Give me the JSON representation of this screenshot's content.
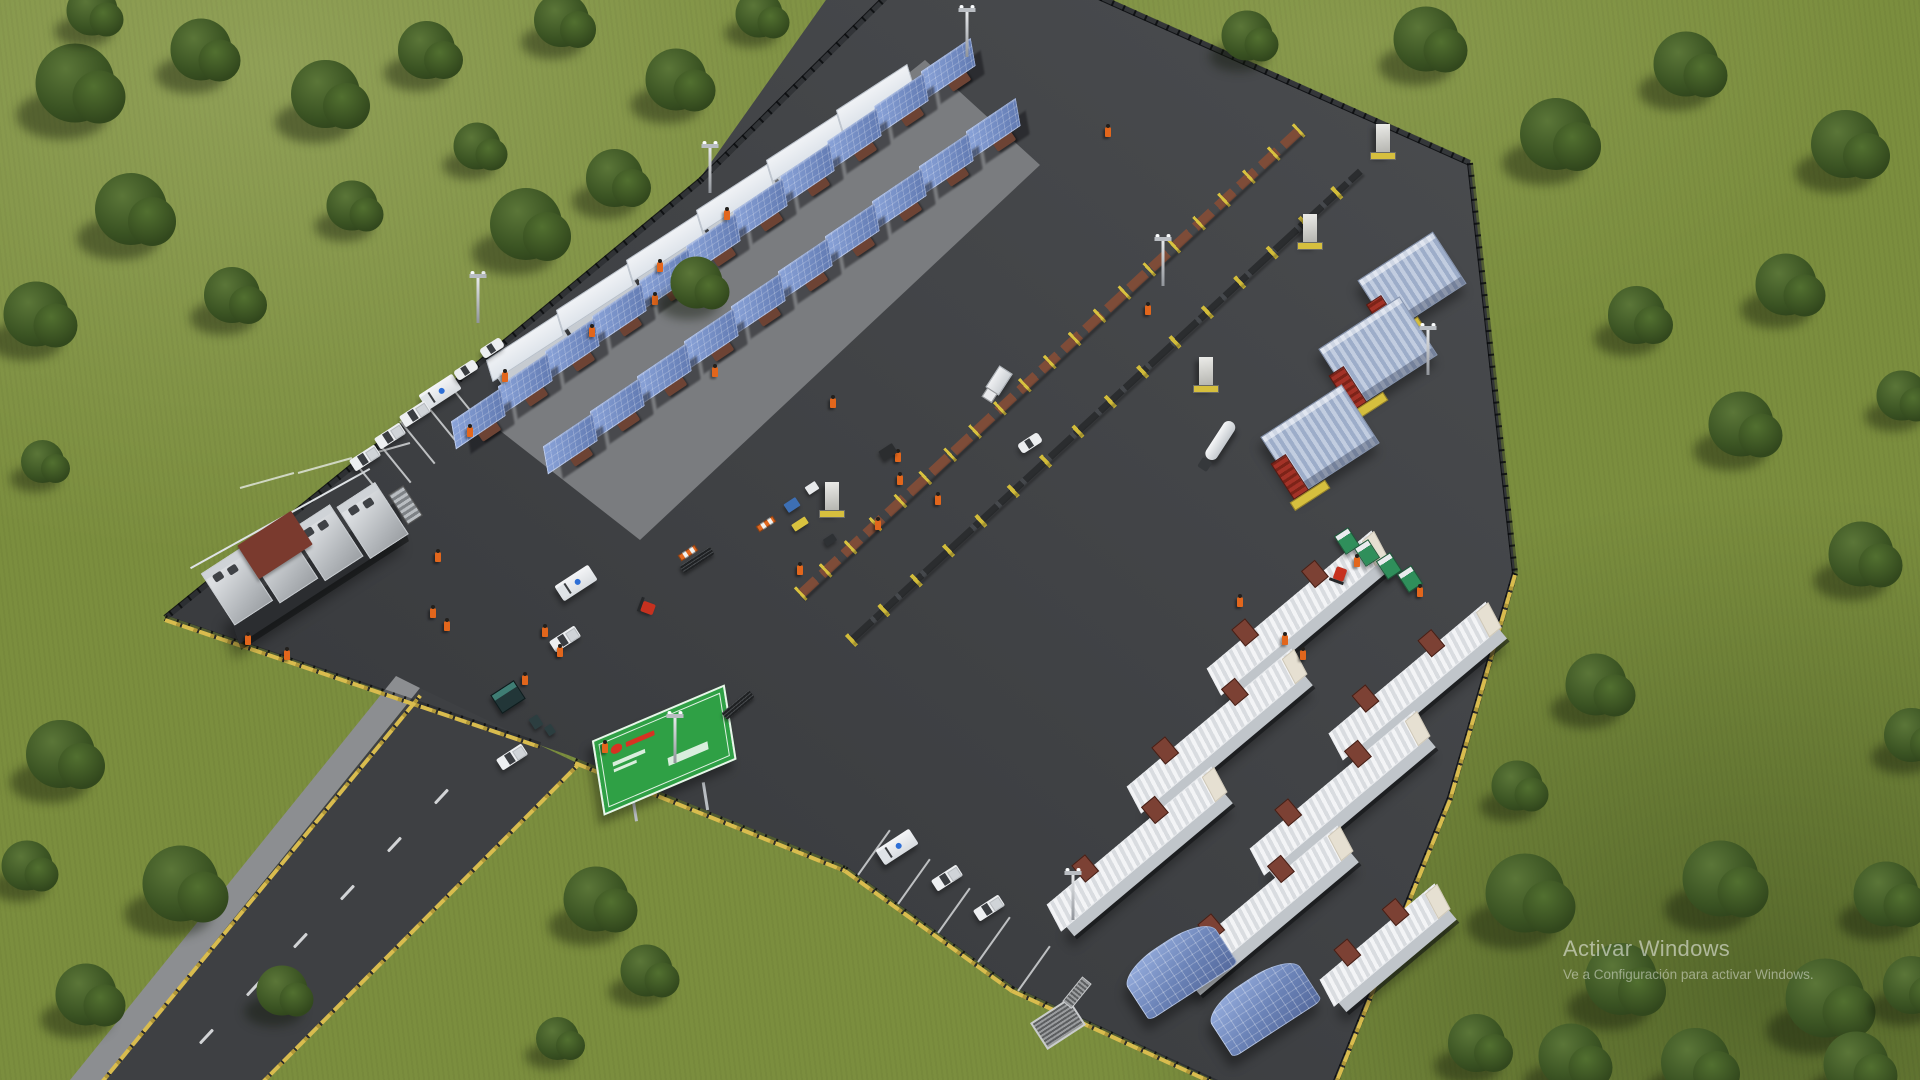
{
  "watermark": {
    "title": "Activar Windows",
    "subtitle": "Ve a Configuración para activar Windows."
  },
  "colors": {
    "grass": "#7b8e3e",
    "grass_shadow": "#5a6c2f",
    "asphalt": "#3f4144",
    "asphalt_light": "#4a4c4f",
    "asphalt_dark": "#35373a",
    "road": "#3e4043",
    "shoulder": "#8c8e91",
    "concrete_pad": "#7a7c7f",
    "curb_yellow": "#d9bc4e",
    "canopy_blue": "#7b96cc",
    "trailer_white": "#eef0f2",
    "stair_brown": "#7c4134",
    "pipe_brown": "#7e4c38",
    "stand_yellow": "#d8c23f",
    "silo_blue": "#b0bdd6",
    "manifold_red": "#a33227",
    "sign_green": "#2fa045",
    "sign_logo_red": "#d63222",
    "worker_orange": "#e2661c",
    "toilet_green": "#2f8f5b",
    "ambulance_star_blue": "#2e6fd6",
    "forklift_red": "#c6311f",
    "tree_green": "#3b5423",
    "watermark_text": "rgba(255,255,255,0.5)"
  },
  "scene": {
    "polygons": [
      {
        "name": "asphalt-pad",
        "fill_key": "pad_gradient",
        "points": "833,-10 1090,-10 1470,160 1515,570 1450,795 1332,1090 1235,1090 1012,986 845,866 568,755 165,615 470,368 700,178"
      },
      {
        "name": "access-road",
        "fill_key": "road",
        "points": "95,1090 258,1090 577,763 420,688"
      },
      {
        "name": "road-shoulder",
        "fill_key": "shoulder",
        "points": "62,1090 95,1090 420,688 396,676"
      },
      {
        "name": "concrete-work-pad",
        "fill_key": "concrete_pad",
        "points": "925,60 1040,165 640,540 480,415"
      }
    ],
    "lines": {
      "fence": [
        [
          890,
          -10,
          700,
          178
        ],
        [
          700,
          178,
          470,
          368
        ],
        [
          470,
          368,
          165,
          615
        ],
        [
          165,
          615,
          540,
          742
        ],
        [
          575,
          758,
          845,
          866
        ],
        [
          845,
          866,
          1012,
          986
        ],
        [
          1012,
          986,
          1235,
          1088
        ],
        [
          1090,
          -10,
          1470,
          160
        ],
        [
          1470,
          160,
          1515,
          570
        ],
        [
          1515,
          570,
          1450,
          795
        ],
        [
          1450,
          795,
          1332,
          1088
        ]
      ],
      "curb": [
        [
          165,
          618,
          540,
          745
        ],
        [
          575,
          761,
          845,
          869
        ],
        [
          845,
          869,
          1012,
          989
        ],
        [
          1012,
          989,
          1235,
          1091
        ],
        [
          1515,
          573,
          1450,
          798
        ],
        [
          1450,
          798,
          1332,
          1091
        ],
        [
          98,
          1085,
          420,
          694
        ],
        [
          258,
          1085,
          577,
          764
        ]
      ],
      "pline": [
        [
          448,
          382,
          483,
          425
        ],
        [
          424,
          401,
          459,
          444
        ],
        [
          400,
          420,
          435,
          463
        ],
        [
          376,
          439,
          411,
          482
        ],
        [
          352,
          458,
          387,
          501
        ],
        [
          240,
          487,
          294,
          472
        ],
        [
          298,
          472,
          352,
          457
        ],
        [
          356,
          457,
          410,
          442
        ],
        [
          858,
          874,
          890,
          829
        ],
        [
          898,
          903,
          930,
          858
        ],
        [
          938,
          932,
          970,
          887
        ],
        [
          978,
          961,
          1010,
          916
        ],
        [
          1018,
          990,
          1050,
          945
        ]
      ],
      "dash": [
        [
          200,
          1042,
          213,
          1028
        ],
        [
          247,
          994,
          260,
          980
        ],
        [
          294,
          946,
          307,
          932
        ],
        [
          341,
          898,
          354,
          884
        ],
        [
          388,
          850,
          401,
          836
        ],
        [
          435,
          802,
          448,
          788
        ]
      ],
      "pipeA": [
        [
          800,
          590,
          1300,
          125
        ]
      ],
      "pipeB": [
        [
          850,
          638,
          1360,
          168
        ]
      ]
    },
    "objects": {
      "bigequip": [
        [
          310,
          560,
          -33
        ]
      ],
      "trailer_nw": [
        [
          880,
          103,
          -33
        ],
        [
          810,
          153,
          -33
        ],
        [
          740,
          203,
          -33
        ],
        [
          670,
          253,
          -33
        ],
        [
          600,
          303,
          -33
        ],
        [
          530,
          353,
          -33
        ]
      ],
      "canopy": [
        [
          955,
          75,
          -34
        ],
        [
          908,
          110,
          -34
        ],
        [
          861,
          145,
          -34
        ],
        [
          814,
          180,
          -34
        ],
        [
          767,
          215,
          -34
        ],
        [
          720,
          250,
          -34
        ],
        [
          673,
          285,
          -34
        ],
        [
          626,
          320,
          -34
        ],
        [
          579,
          355,
          -34
        ],
        [
          532,
          390,
          -34
        ],
        [
          485,
          425,
          -34
        ],
        [
          1000,
          135,
          -34
        ],
        [
          953,
          170,
          -34
        ],
        [
          906,
          205,
          -34
        ],
        [
          859,
          240,
          -34
        ],
        [
          812,
          275,
          -34
        ],
        [
          765,
          310,
          -34
        ],
        [
          718,
          345,
          -34
        ],
        [
          671,
          380,
          -34
        ],
        [
          624,
          415,
          -34
        ],
        [
          577,
          450,
          -34
        ]
      ],
      "pillar": [
        [
          1383,
          140,
          0
        ],
        [
          1310,
          230,
          0
        ],
        [
          1206,
          373,
          0
        ],
        [
          832,
          498,
          0
        ]
      ],
      "silo": [
        [
          1412,
          282,
          -33,
          88,
          60
        ],
        [
          1378,
          352,
          -33,
          95,
          68
        ],
        [
          1320,
          440,
          -33,
          95,
          68
        ]
      ],
      "tanker": [
        [
          1218,
          445,
          -57
        ]
      ],
      "boxtruck": [
        [
          995,
          385,
          -57
        ]
      ],
      "trailer_long": [
        [
          1302,
          620,
          -40,
          215
        ],
        [
          1222,
          738,
          -40,
          215
        ],
        [
          1142,
          856,
          -40,
          215
        ],
        [
          1420,
          688,
          -40,
          205
        ],
        [
          1345,
          800,
          -40,
          215
        ],
        [
          1268,
          915,
          -40,
          215
        ],
        [
          1390,
          952,
          -40,
          150
        ]
      ],
      "solar": [
        [
          1178,
          968,
          -33,
          106,
          58
        ],
        [
          1262,
          1005,
          -33,
          106,
          58
        ]
      ],
      "ambulance": [
        [
          440,
          392,
          -33
        ],
        [
          576,
          583,
          -33
        ],
        [
          897,
          847,
          -33
        ]
      ],
      "pickup": [
        [
          415,
          414,
          -33
        ],
        [
          390,
          436,
          -33
        ],
        [
          365,
          458,
          -33
        ],
        [
          565,
          639,
          -33
        ],
        [
          512,
          757,
          -33
        ],
        [
          947,
          878,
          -33
        ],
        [
          989,
          908,
          -33
        ]
      ],
      "car": [
        [
          492,
          348,
          -33
        ],
        [
          466,
          370,
          -33
        ],
        [
          1030,
          443,
          -33
        ]
      ],
      "forklift": [
        [
          648,
          608,
          20
        ],
        [
          1340,
          574,
          -70
        ]
      ],
      "toilet": [
        [
          1347,
          541,
          -33
        ],
        [
          1367,
          553,
          -33
        ],
        [
          1389,
          566,
          -33
        ],
        [
          1410,
          579,
          -33
        ]
      ],
      "booth": [
        [
          508,
          697,
          -33
        ]
      ],
      "sign": [
        [
          665,
          755,
          -9
        ]
      ],
      "grate": [
        [
          1058,
          1024,
          -33
        ]
      ],
      "bundle": [
        [
          697,
          560,
          -33
        ],
        [
          738,
          705,
          -40
        ]
      ],
      "barrier": [
        [
          688,
          553,
          -33
        ],
        [
          766,
          524,
          -33
        ]
      ],
      "pole": [
        [
          710,
          170,
          0
        ],
        [
          478,
          300,
          0
        ],
        [
          675,
          740,
          0
        ],
        [
          1073,
          897,
          0
        ],
        [
          1428,
          352,
          0
        ],
        [
          1163,
          263,
          0
        ],
        [
          967,
          34,
          0
        ]
      ],
      "worker": [
        [
          715,
          372,
          0
        ],
        [
          833,
          403,
          0
        ],
        [
          898,
          457,
          0
        ],
        [
          727,
          215,
          0
        ],
        [
          660,
          267,
          0
        ],
        [
          505,
          377,
          0
        ],
        [
          470,
          432,
          0
        ],
        [
          438,
          557,
          0
        ],
        [
          433,
          613,
          0
        ],
        [
          447,
          626,
          0
        ],
        [
          525,
          680,
          0
        ],
        [
          605,
          748,
          0
        ],
        [
          545,
          632,
          0
        ],
        [
          560,
          652,
          0
        ],
        [
          900,
          480,
          0
        ],
        [
          938,
          500,
          0
        ],
        [
          1240,
          602,
          0
        ],
        [
          1285,
          640,
          0
        ],
        [
          1303,
          655,
          0
        ],
        [
          1357,
          562,
          0
        ],
        [
          1420,
          592,
          0
        ],
        [
          878,
          525,
          0
        ],
        [
          800,
          570,
          0
        ],
        [
          655,
          300,
          0
        ],
        [
          592,
          332,
          0
        ],
        [
          1108,
          132,
          0
        ],
        [
          1148,
          310,
          0
        ],
        [
          248,
          640,
          0
        ],
        [
          287,
          655,
          0
        ]
      ]
    },
    "boxes": [
      [
        275,
        545,
        64,
        40,
        -33,
        "#7a3a2e"
      ],
      [
        792,
        505,
        14,
        10,
        -33,
        "#3d6fb4"
      ],
      [
        812,
        488,
        12,
        9,
        -33,
        "#e8eaec"
      ],
      [
        800,
        524,
        16,
        8,
        -33,
        "#d8c23f"
      ],
      [
        830,
        540,
        12,
        8,
        -33,
        "#2e3134"
      ],
      [
        888,
        452,
        16,
        11,
        -33,
        "#2b2d2f"
      ],
      [
        536,
        722,
        10,
        12,
        -33,
        "#2c3e40"
      ],
      [
        550,
        730,
        8,
        10,
        -33,
        "#2c3e40"
      ]
    ],
    "trees": [
      [
        80,
        90,
        1.1
      ],
      [
        205,
        55,
        0.85
      ],
      [
        330,
        100,
        0.95
      ],
      [
        135,
        215,
        1.0
      ],
      [
        40,
        320,
        0.9
      ],
      [
        235,
        300,
        0.78
      ],
      [
        355,
        210,
        0.7
      ],
      [
        95,
        15,
        0.7
      ],
      [
        45,
        465,
        0.6
      ],
      [
        65,
        760,
        0.95
      ],
      [
        185,
        890,
        1.05
      ],
      [
        90,
        1000,
        0.85
      ],
      [
        285,
        995,
        0.7
      ],
      [
        30,
        870,
        0.7
      ],
      [
        600,
        905,
        0.9
      ],
      [
        650,
        975,
        0.72
      ],
      [
        560,
        1042,
        0.6
      ],
      [
        430,
        55,
        0.8
      ],
      [
        565,
        25,
        0.75
      ],
      [
        680,
        85,
        0.85
      ],
      [
        762,
        18,
        0.65
      ],
      [
        530,
        230,
        1.0
      ],
      [
        618,
        183,
        0.8
      ],
      [
        700,
        287,
        0.72
      ],
      [
        480,
        150,
        0.65
      ],
      [
        1250,
        40,
        0.7
      ],
      [
        1430,
        45,
        0.9
      ],
      [
        1560,
        140,
        1.0
      ],
      [
        1690,
        70,
        0.9
      ],
      [
        1850,
        150,
        0.95
      ],
      [
        1790,
        290,
        0.85
      ],
      [
        1640,
        320,
        0.8
      ],
      [
        1745,
        430,
        0.9
      ],
      [
        1865,
        560,
        0.9
      ],
      [
        1905,
        400,
        0.7
      ],
      [
        1600,
        690,
        0.85
      ],
      [
        1520,
        790,
        0.7
      ],
      [
        1530,
        900,
        1.1
      ],
      [
        1625,
        985,
        1.0
      ],
      [
        1725,
        885,
        1.05
      ],
      [
        1830,
        1005,
        1.1
      ],
      [
        1890,
        900,
        0.9
      ],
      [
        1575,
        1062,
        0.9
      ],
      [
        1700,
        1068,
        0.95
      ],
      [
        1860,
        1070,
        0.9
      ],
      [
        1480,
        1048,
        0.8
      ],
      [
        1915,
        990,
        0.8
      ],
      [
        1915,
        740,
        0.75
      ]
    ]
  }
}
